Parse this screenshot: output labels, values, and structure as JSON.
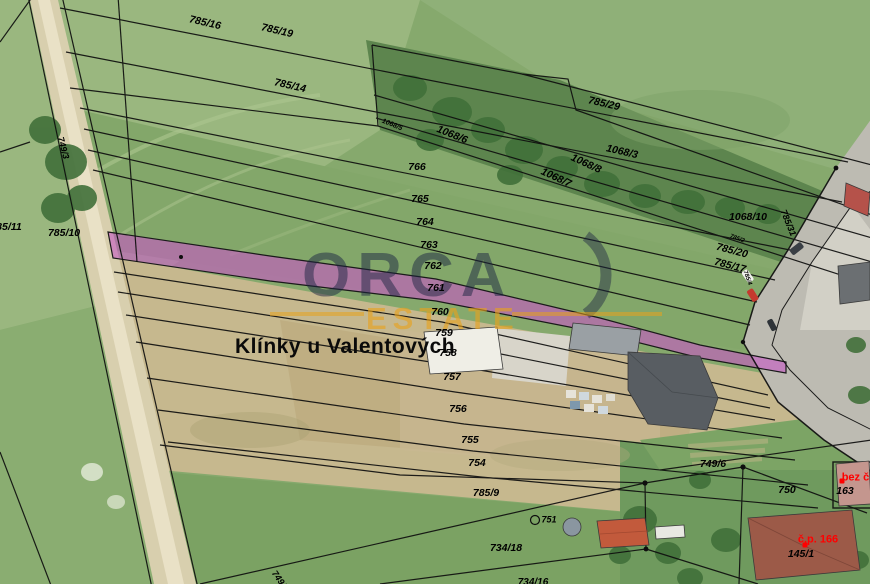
{
  "map": {
    "place_label": "Klínky u Valentových",
    "watermark": {
      "line1": "ORCA",
      "line2": "ESTATE",
      "primary_color": "rgba(28,38,66,0.50)",
      "accent_color": "rgba(232,162,28,0.62)"
    },
    "highlight": {
      "parcel": "761",
      "color": "#c55bc4"
    },
    "parcel_labels": [
      {
        "text": "785/16",
        "x": 205,
        "y": 23,
        "rot": 13
      },
      {
        "text": "785/19",
        "x": 277,
        "y": 31,
        "rot": 13
      },
      {
        "text": "785/14",
        "x": 290,
        "y": 86,
        "rot": 13
      },
      {
        "text": "785/29",
        "x": 604,
        "y": 104,
        "rot": 13
      },
      {
        "text": "1068/5",
        "x": 392,
        "y": 125,
        "rot": 22,
        "size": 7
      },
      {
        "text": "1068/6",
        "x": 452,
        "y": 135,
        "rot": 22
      },
      {
        "text": "1068/3",
        "x": 622,
        "y": 152,
        "rot": 13
      },
      {
        "text": "1068/8",
        "x": 586,
        "y": 164,
        "rot": 25
      },
      {
        "text": "1068/7",
        "x": 556,
        "y": 178,
        "rot": 25
      },
      {
        "text": "766",
        "x": 417,
        "y": 167
      },
      {
        "text": "765",
        "x": 420,
        "y": 199
      },
      {
        "text": "764",
        "x": 425,
        "y": 222
      },
      {
        "text": "763",
        "x": 429,
        "y": 245
      },
      {
        "text": "762",
        "x": 433,
        "y": 266
      },
      {
        "text": "761",
        "x": 436,
        "y": 288
      },
      {
        "text": "760",
        "x": 440,
        "y": 312
      },
      {
        "text": "759",
        "x": 444,
        "y": 333
      },
      {
        "text": "758",
        "x": 448,
        "y": 353
      },
      {
        "text": "757",
        "x": 452,
        "y": 377
      },
      {
        "text": "756",
        "x": 458,
        "y": 409
      },
      {
        "text": "755",
        "x": 470,
        "y": 440
      },
      {
        "text": "754",
        "x": 477,
        "y": 463
      },
      {
        "text": "785/9",
        "x": 486,
        "y": 493
      },
      {
        "text": "749/3",
        "x": 63,
        "y": 148,
        "rot": 75,
        "size": 9
      },
      {
        "text": "785/11",
        "x": 6,
        "y": 227
      },
      {
        "text": "785/10",
        "x": 64,
        "y": 233
      },
      {
        "text": "1068/10",
        "x": 748,
        "y": 217
      },
      {
        "text": "785/31",
        "x": 788,
        "y": 223,
        "rot": 68,
        "size": 9
      },
      {
        "text": "785/2",
        "x": 737,
        "y": 239,
        "rot": 20,
        "size": 6
      },
      {
        "text": "785/20",
        "x": 732,
        "y": 251,
        "rot": 15
      },
      {
        "text": "785/17",
        "x": 730,
        "y": 266,
        "rot": 15
      },
      {
        "text": "785/4",
        "x": 747,
        "y": 278,
        "rot": 70,
        "size": 6
      },
      {
        "text": "749/6",
        "x": 713,
        "y": 464
      },
      {
        "text": "750",
        "x": 787,
        "y": 490
      },
      {
        "text": "163",
        "x": 845,
        "y": 491
      },
      {
        "text": "751",
        "x": 549,
        "y": 520,
        "size": 9
      },
      {
        "text": "734/18",
        "x": 506,
        "y": 548
      },
      {
        "text": "734/16",
        "x": 533,
        "y": 583,
        "size": 10
      },
      {
        "text": "749/2",
        "x": 280,
        "y": 581,
        "rot": 55,
        "size": 9
      },
      {
        "text": "145/1",
        "x": 801,
        "y": 554
      },
      {
        "text": "bez č.",
        "x": 857,
        "y": 478,
        "color": "#ff0000",
        "red": true,
        "size": 11
      },
      {
        "text": "č.p. 166",
        "x": 818,
        "y": 540,
        "color": "#ff0000",
        "red": true,
        "size": 11
      }
    ],
    "red_dots": [
      {
        "x": 842,
        "y": 481
      },
      {
        "x": 805,
        "y": 545
      }
    ]
  }
}
